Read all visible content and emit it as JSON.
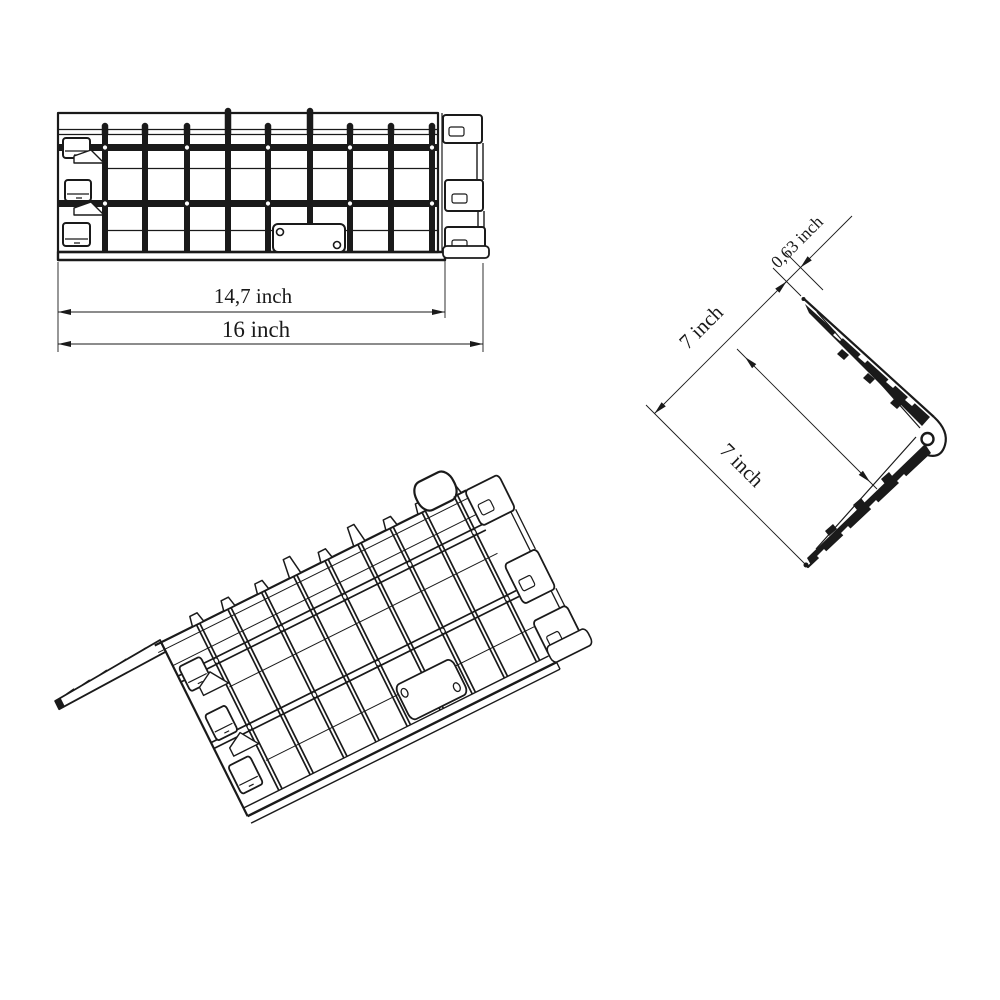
{
  "colors": {
    "line": "#1a1a1a",
    "background": "#ffffff"
  },
  "views": {
    "top_view": {
      "dimensions": {
        "inner_width": "14,7 inch",
        "overall_width": "16 inch"
      }
    },
    "side_view": {
      "dimensions": {
        "edge_thickness": "0,63 inch",
        "upper_side": "7 inch",
        "lower_side": "7 inch"
      }
    }
  }
}
